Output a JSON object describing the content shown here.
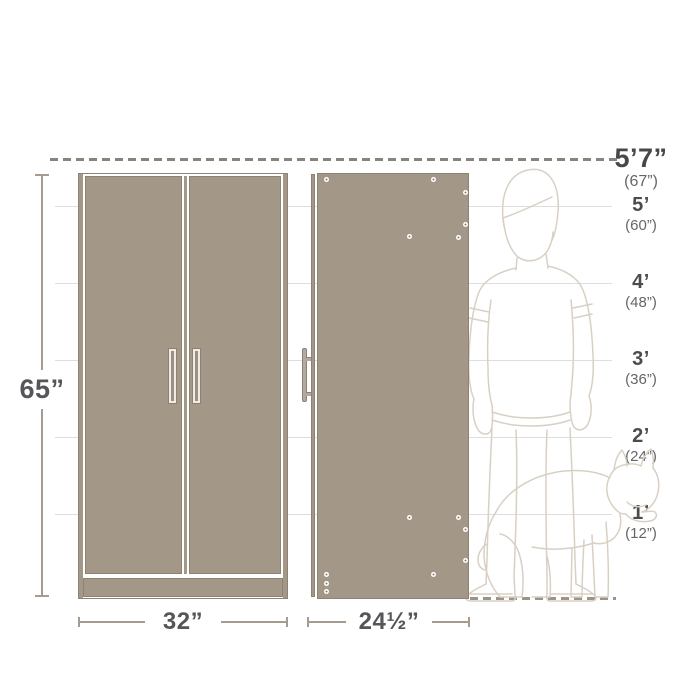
{
  "product_dimensions": {
    "height": "65”",
    "width": "32”",
    "depth": "24½”"
  },
  "height_scale": {
    "reference_height": {
      "feet_label": "5’7”",
      "inches_label": "(67”)"
    },
    "markers": [
      {
        "feet_label": "5’",
        "inches_label": "(60”)"
      },
      {
        "feet_label": "4’",
        "inches_label": "(48”)"
      },
      {
        "feet_label": "3’",
        "inches_label": "(36”)"
      },
      {
        "feet_label": "2’",
        "inches_label": "(24”)"
      },
      {
        "feet_label": "1’",
        "inches_label": "(12”)"
      }
    ]
  },
  "colors": {
    "cabinet_fill": "#a39788",
    "cabinet_edge": "#8e8275",
    "dimension_line": "#a59b8e",
    "dimension_text": "#56565a",
    "marker_text_primary": "#4c4c4f",
    "marker_text_secondary": "#66666a",
    "dashed_reference": "#89837b",
    "figure_outline": "#d9d0c4",
    "gridline": "#dedede",
    "ground_dash": "#9b948a"
  }
}
